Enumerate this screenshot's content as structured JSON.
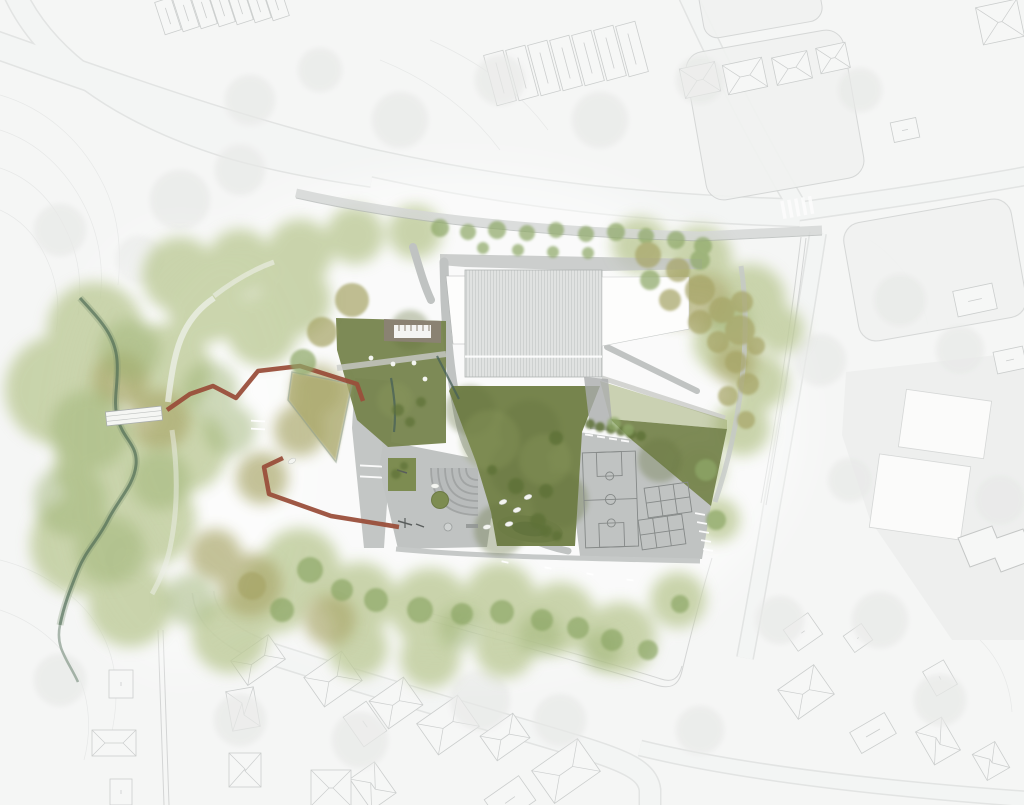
{
  "meta": {
    "drawing_type": "architectural site plan",
    "rendering_style": "watercolor plan view"
  },
  "palette": {
    "bg": "#f3f4f3",
    "road_fill": "#eef0ef",
    "context_line": "#a9adac",
    "contour": "#c8cbca",
    "canopy_gray": "#d7d9d6",
    "house_fill": "#f4f5f4",
    "house_line": "#9ba09f",
    "fence_line": "#9b9f9e",
    "wash_green": "#bdca98",
    "wash_green2": "#9eb375",
    "wash_olive": "#aba96d",
    "lawn": "#76844d",
    "lawn_bright": "#7d8c51",
    "lawn_light": "#9aa869",
    "knoll": "#6d7c45",
    "paving": "#c0c3c2",
    "paving_dark": "#aaadac",
    "court_line": "#858988",
    "roof_rib_fill": "#e0e2e1",
    "roof_rib_line": "#c7cac9",
    "roof_white": "#fdfdfc",
    "building_line": "#b0b3b2",
    "pergola": "#8b8274",
    "corten": "#9a4f3b",
    "stream": "#4c6853",
    "water": "#476058",
    "tree_green": "#8ea868",
    "tree_olive": "#a7a567",
    "tree_dark": "#5e7238",
    "white_item": "#f4f5f1"
  },
  "features": [
    {
      "id": "school-building",
      "label": "main building with ribbed roof"
    },
    {
      "id": "entry-plaza",
      "label": "paved entry plaza with amphitheater steps"
    },
    {
      "id": "central-lawn",
      "label": "central lawn"
    },
    {
      "id": "sports-pavement",
      "label": "paved sports area with basketball and game courts"
    },
    {
      "id": "corten-walkway",
      "label": "red corten zigzag boardwalk"
    },
    {
      "id": "wild-garden",
      "label": "wild planting triangle"
    },
    {
      "id": "pergola-patio",
      "label": "sunken pergola patio"
    },
    {
      "id": "play-hill",
      "label": "planted play hill"
    },
    {
      "id": "stream",
      "label": "stream with footbridge"
    },
    {
      "id": "riparian-corridor",
      "label": "riparian woodland corridor"
    },
    {
      "id": "context",
      "label": "surrounding streets and houses"
    }
  ],
  "planting": {
    "site_trees": [
      [
        352,
        300,
        17,
        "o"
      ],
      [
        322,
        332,
        15,
        "o"
      ],
      [
        303,
        362,
        13,
        "g"
      ],
      [
        398,
        410,
        6,
        "d"
      ],
      [
        410,
        422,
        5,
        "d"
      ],
      [
        421,
        402,
        5,
        "d"
      ],
      [
        440,
        228,
        9,
        "g"
      ],
      [
        468,
        232,
        8,
        "g"
      ],
      [
        497,
        230,
        9,
        "g"
      ],
      [
        527,
        233,
        8,
        "g"
      ],
      [
        556,
        230,
        8,
        "g"
      ],
      [
        586,
        234,
        8,
        "g"
      ],
      [
        616,
        232,
        9,
        "g"
      ],
      [
        646,
        236,
        8,
        "g"
      ],
      [
        676,
        240,
        9,
        "g"
      ],
      [
        703,
        246,
        9,
        "g"
      ],
      [
        483,
        248,
        6,
        "g"
      ],
      [
        518,
        250,
        6,
        "g"
      ],
      [
        553,
        252,
        6,
        "g"
      ],
      [
        588,
        253,
        6,
        "g"
      ],
      [
        648,
        255,
        13,
        "o"
      ],
      [
        678,
        270,
        12,
        "o"
      ],
      [
        700,
        290,
        15,
        "o"
      ],
      [
        722,
        310,
        13,
        "o"
      ],
      [
        740,
        330,
        15,
        "o"
      ],
      [
        718,
        342,
        11,
        "o"
      ],
      [
        700,
        322,
        12,
        "o"
      ],
      [
        736,
        362,
        11,
        "o"
      ],
      [
        748,
        384,
        11,
        "o"
      ],
      [
        670,
        300,
        11,
        "o"
      ],
      [
        742,
        302,
        11,
        "o"
      ],
      [
        700,
        260,
        10,
        "g"
      ],
      [
        756,
        346,
        9,
        "o"
      ],
      [
        728,
        396,
        10,
        "o"
      ],
      [
        746,
        420,
        9,
        "o"
      ],
      [
        650,
        280,
        10,
        "g"
      ],
      [
        614,
        424,
        7,
        "g"
      ],
      [
        628,
        430,
        6,
        "g"
      ],
      [
        310,
        570,
        13,
        "g"
      ],
      [
        342,
        590,
        11,
        "g"
      ],
      [
        376,
        600,
        12,
        "g"
      ],
      [
        420,
        610,
        13,
        "g"
      ],
      [
        462,
        614,
        11,
        "g"
      ],
      [
        502,
        612,
        12,
        "g"
      ],
      [
        542,
        620,
        11,
        "g"
      ],
      [
        578,
        628,
        11,
        "g"
      ],
      [
        612,
        640,
        11,
        "g"
      ],
      [
        648,
        650,
        10,
        "g"
      ],
      [
        252,
        586,
        14,
        "o"
      ],
      [
        282,
        610,
        12,
        "g"
      ],
      [
        680,
        604,
        9,
        "g"
      ],
      [
        706,
        470,
        11,
        "g"
      ],
      [
        716,
        520,
        10,
        "g"
      ],
      [
        396,
        474,
        5,
        "d"
      ],
      [
        404,
        466,
        4,
        "d"
      ]
    ],
    "shrubs": [
      [
        516,
        486,
        8
      ],
      [
        546,
        491,
        7
      ],
      [
        556,
        438,
        7
      ],
      [
        538,
        521,
        8
      ],
      [
        492,
        470,
        5
      ],
      [
        590,
        424,
        5
      ],
      [
        600,
        427,
        5
      ],
      [
        611,
        429,
        5
      ],
      [
        621,
        431,
        5
      ],
      [
        631,
        434,
        5
      ],
      [
        641,
        436,
        5
      ],
      [
        546,
        531,
        6
      ],
      [
        557,
        536,
        5
      ]
    ]
  },
  "context_canopies": [
    [
      180,
      200,
      30
    ],
    [
      240,
      170,
      25
    ],
    [
      400,
      120,
      28
    ],
    [
      500,
      80,
      25
    ],
    [
      600,
      120,
      28
    ],
    [
      700,
      80,
      24
    ],
    [
      250,
      100,
      25
    ],
    [
      320,
      70,
      22
    ],
    [
      140,
      260,
      24
    ],
    [
      60,
      230,
      26
    ],
    [
      860,
      90,
      22
    ],
    [
      900,
      300,
      26
    ],
    [
      960,
      350,
      24
    ],
    [
      820,
      360,
      26
    ],
    [
      880,
      620,
      28
    ],
    [
      780,
      620,
      24
    ],
    [
      940,
      700,
      26
    ],
    [
      480,
      700,
      30
    ],
    [
      560,
      720,
      26
    ],
    [
      360,
      740,
      28
    ],
    [
      240,
      720,
      26
    ],
    [
      130,
      560,
      24
    ],
    [
      60,
      680,
      26
    ],
    [
      700,
      730,
      24
    ],
    [
      1000,
      500,
      25
    ],
    [
      850,
      480,
      22
    ]
  ],
  "context_houses": [
    [
      168,
      16,
      17,
      34,
      -18,
      "ridge"
    ],
    [
      186,
      13,
      17,
      34,
      -18,
      "ridge"
    ],
    [
      204,
      10,
      17,
      34,
      -18,
      "ridge"
    ],
    [
      222,
      8,
      17,
      34,
      -18,
      "ridge"
    ],
    [
      240,
      6,
      17,
      34,
      -18,
      "ridge"
    ],
    [
      258,
      4,
      17,
      34,
      -18,
      "ridge"
    ],
    [
      276,
      2,
      17,
      34,
      -18,
      "ridge"
    ],
    [
      500,
      78,
      20,
      52,
      -15,
      "ridge"
    ],
    [
      522,
      73,
      20,
      52,
      -15,
      "ridge"
    ],
    [
      544,
      68,
      20,
      52,
      -15,
      "ridge"
    ],
    [
      566,
      63,
      20,
      52,
      -15,
      "ridge"
    ],
    [
      588,
      58,
      20,
      52,
      -15,
      "ridge"
    ],
    [
      610,
      53,
      20,
      52,
      -15,
      "ridge"
    ],
    [
      632,
      49,
      20,
      52,
      -15,
      "ridge"
    ],
    [
      700,
      80,
      36,
      30,
      -12,
      "hip"
    ],
    [
      745,
      76,
      40,
      30,
      -12,
      "hip"
    ],
    [
      792,
      68,
      36,
      28,
      -12,
      "hip"
    ],
    [
      833,
      58,
      30,
      26,
      -12,
      "hip"
    ],
    [
      1000,
      22,
      42,
      38,
      -12,
      "hip"
    ],
    [
      905,
      130,
      26,
      20,
      -12,
      "ridge"
    ],
    [
      975,
      300,
      40,
      26,
      -12,
      "ridge"
    ],
    [
      1010,
      360,
      30,
      22,
      -12,
      "ridge"
    ],
    [
      121,
      684,
      24,
      28,
      0,
      "ridge"
    ],
    [
      114,
      743,
      44,
      26,
      0,
      "hip"
    ],
    [
      121,
      792,
      22,
      26,
      0,
      "ridge"
    ],
    [
      258,
      660,
      46,
      30,
      -35,
      "hip"
    ],
    [
      243,
      709,
      28,
      40,
      -10,
      "hip"
    ],
    [
      245,
      770,
      32,
      34,
      0,
      "hip"
    ],
    [
      333,
      679,
      46,
      36,
      -35,
      "hip"
    ],
    [
      365,
      724,
      28,
      36,
      -35,
      "ridge"
    ],
    [
      373,
      786,
      30,
      38,
      -35,
      "hip"
    ],
    [
      396,
      703,
      42,
      34,
      -35,
      "hip"
    ],
    [
      448,
      725,
      50,
      38,
      -35,
      "hip"
    ],
    [
      505,
      737,
      40,
      30,
      -35,
      "hip"
    ],
    [
      566,
      771,
      56,
      40,
      -35,
      "hip"
    ],
    [
      510,
      800,
      42,
      30,
      -35,
      "ridge"
    ],
    [
      331,
      788,
      40,
      36,
      0,
      "hip"
    ],
    [
      803,
      632,
      30,
      26,
      -35,
      "ridge"
    ],
    [
      806,
      692,
      44,
      36,
      -35,
      "hip"
    ],
    [
      858,
      638,
      22,
      20,
      -35,
      "ridge"
    ],
    [
      938,
      741,
      30,
      38,
      -30,
      "hip"
    ],
    [
      940,
      678,
      24,
      28,
      -30,
      "ridge"
    ],
    [
      991,
      761,
      26,
      30,
      -30,
      "hip"
    ],
    [
      873,
      733,
      40,
      24,
      -30,
      "ridge"
    ]
  ],
  "markings": {
    "dashes": [
      [
        700,
        514,
        10,
        10
      ],
      [
        702,
        523,
        10,
        10
      ],
      [
        704,
        532,
        10,
        10
      ],
      [
        706,
        541,
        10,
        10
      ],
      [
        708,
        550,
        10,
        10
      ],
      [
        589,
        435,
        8,
        8
      ],
      [
        601,
        437,
        8,
        8
      ],
      [
        613,
        439,
        8,
        8
      ],
      [
        625,
        441,
        8,
        8
      ],
      [
        371,
        466,
        22,
        3
      ],
      [
        371,
        477,
        22,
        3
      ],
      [
        505,
        562,
        7,
        12
      ],
      [
        548,
        568,
        7,
        10
      ],
      [
        590,
        574,
        7,
        10
      ],
      [
        630,
        580,
        7,
        8
      ],
      [
        258,
        429,
        14,
        3
      ],
      [
        258,
        421,
        14,
        3
      ]
    ],
    "bench_ovals": [
      [
        503,
        502,
        -20
      ],
      [
        517,
        510,
        -20
      ],
      [
        509,
        524,
        -15
      ],
      [
        528,
        497,
        -20
      ],
      [
        487,
        527,
        -10
      ],
      [
        292,
        461,
        -30
      ],
      [
        435,
        486,
        0
      ]
    ],
    "white_dots": [
      [
        371,
        358
      ],
      [
        393,
        364
      ],
      [
        414,
        363
      ],
      [
        425,
        379
      ]
    ]
  }
}
